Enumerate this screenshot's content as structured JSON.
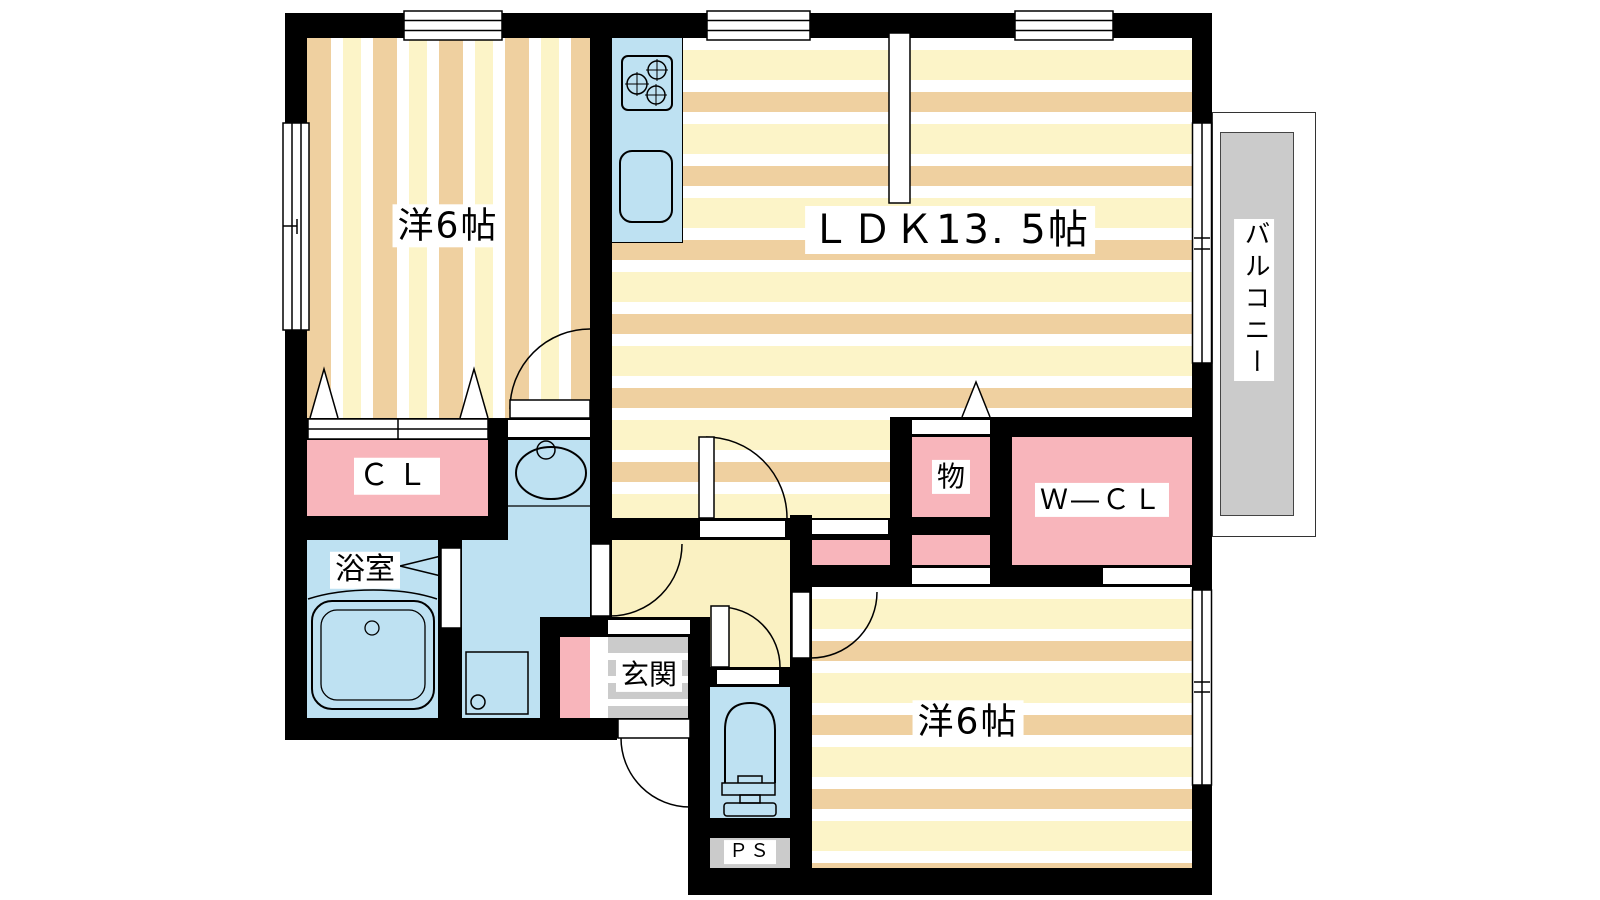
{
  "plan_title": "apartment floor plan",
  "rooms": {
    "bedroom1": {
      "label": "洋6帖"
    },
    "ldk": {
      "label": "ＬＤＫ13. 5帖"
    },
    "bedroom2": {
      "label": "洋6帖"
    },
    "balcony": {
      "label": "バルコニー"
    },
    "closet": {
      "label": "ＣＬ"
    },
    "walk_in_closet": {
      "label": "Ｗ―ＣＬ"
    },
    "storage": {
      "label": "物"
    },
    "bathroom": {
      "label": "浴室"
    },
    "entrance": {
      "label": "玄関"
    },
    "pipe_space": {
      "label": "ＰＳ"
    }
  },
  "colors": {
    "wall": "#000000",
    "water_blue": "#bee1f2",
    "closet_pink": "#f8b5bb",
    "stripe_tan": "#efd0a0",
    "stripe_cream": "#fcf4c8",
    "hallway_yellow": "#faf1c2",
    "floor_gray": "#cbcbcb"
  }
}
